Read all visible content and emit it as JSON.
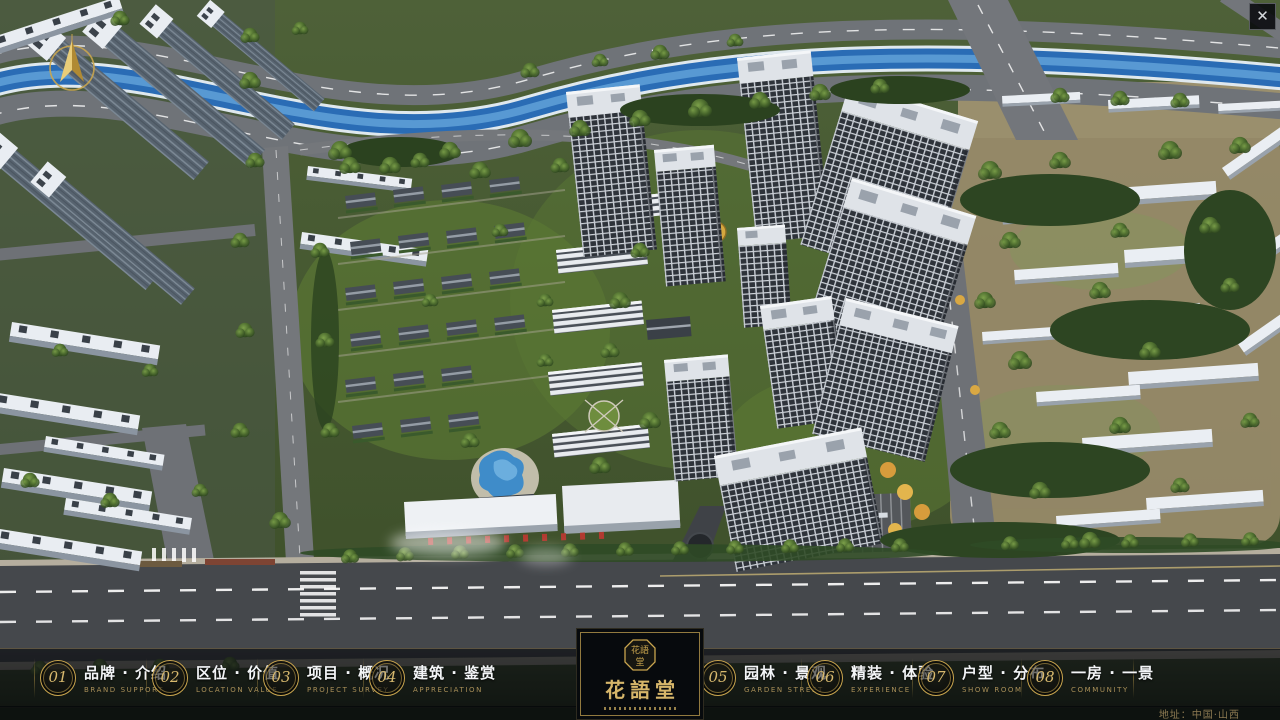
{
  "theme": {
    "gold": "#c9a54e",
    "panel_dark": "#070a0d",
    "bar_line": "#d6bc82"
  },
  "viewport": {
    "close_glyph": "✕"
  },
  "nav": {
    "items": [
      {
        "num": "01",
        "label": "品牌 · 介绍",
        "sub": "BRAND SUPPORT"
      },
      {
        "num": "02",
        "label": "区位 · 价值",
        "sub": "LOCATION VALUE"
      },
      {
        "num": "03",
        "label": "项目 · 概况",
        "sub": "PROJECT SURVEY"
      },
      {
        "num": "04",
        "label": "建筑 · 鉴赏",
        "sub": "APPRECIATION"
      },
      {
        "num": "05",
        "label": "园林 · 景观",
        "sub": "GARDEN STREET"
      },
      {
        "num": "06",
        "label": "精装 · 体验",
        "sub": "EXPERIENCE"
      },
      {
        "num": "07",
        "label": "户型 · 分布",
        "sub": "SHOW ROOM"
      },
      {
        "num": "08",
        "label": "一房 · 一景",
        "sub": "COMMUNITY"
      }
    ]
  },
  "logo": {
    "title": "花語堂",
    "seal_top": "花語",
    "seal_bottom": "堂"
  },
  "footer": {
    "address": "地址：中国·山西"
  }
}
